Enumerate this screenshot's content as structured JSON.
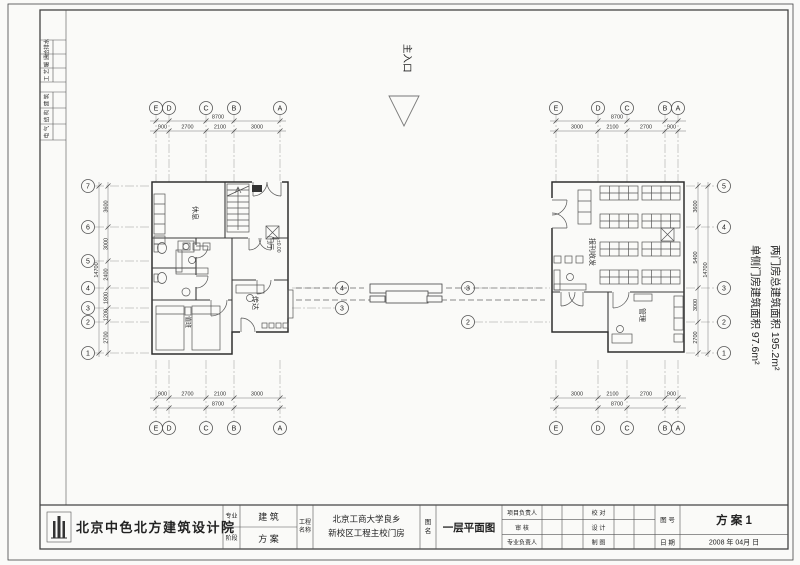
{
  "titleblock": {
    "company": "北京中色北方建筑设计院",
    "discipline_label": "专业",
    "stage_label": "阶段",
    "discipline": "建 筑",
    "stage": "方 案",
    "project_label_1": "工程",
    "project_label_2": "名称",
    "project_line1": "北京工商大学良乡",
    "project_line2": "新校区工程主校门房",
    "drawing_name_label_1": "图",
    "drawing_name_label_2": "名",
    "drawing_name": "一层平面图",
    "role_pm": "项目负责人",
    "role_review": "审  核",
    "role_lead": "专业负责人",
    "role_check": "校  对",
    "role_design": "设  计",
    "role_draft": "制  图",
    "sheet_no_label": "图 号",
    "sheet_no": "方 案 1",
    "date_label": "日 期",
    "date": "2008 年    04月    日"
  },
  "signoff": {
    "row1": "给排水",
    "row2": "暖 通",
    "row3": "工 艺",
    "row4": "建 筑",
    "row5": "结 构",
    "row6": "电 气"
  },
  "annotations": {
    "entrance": "主入口",
    "area_note_side": "单侧门房建筑面积 97.6m²",
    "area_note_total": "两门房总建筑面积 195.2m²"
  },
  "left_plan": {
    "rooms": {
      "rest": "休息",
      "hall": "门厅",
      "hall_level": "±0.00",
      "duty": "值班",
      "reception": "传达"
    },
    "grid_top": {
      "letters": [
        "E",
        "D",
        "C",
        "B",
        "A"
      ],
      "dims": [
        "900",
        "2700",
        "2100",
        "3000"
      ],
      "total": "8700"
    },
    "grid_side": {
      "numbers": [
        "7",
        "6",
        "5",
        "4",
        "3",
        "2",
        "1"
      ],
      "dims": [
        "3600",
        "3000",
        "2400",
        "1800",
        "1200",
        "2700"
      ],
      "total": "14700"
    },
    "inner": [
      "4",
      "3"
    ]
  },
  "right_plan": {
    "rooms": {
      "mail": "报刊收发",
      "office": "管理"
    },
    "grid_top": {
      "letters": [
        "E",
        "D",
        "C",
        "B",
        "A"
      ],
      "dims": [
        "3000",
        "2100",
        "2700",
        "900"
      ],
      "total": "8700"
    },
    "grid_side": {
      "numbers": [
        "5",
        "4",
        "3",
        "2",
        "1"
      ],
      "dims": [
        "3600",
        "5400",
        "3000",
        "2700"
      ],
      "total": "14700"
    },
    "inner": [
      "3",
      "2"
    ]
  }
}
